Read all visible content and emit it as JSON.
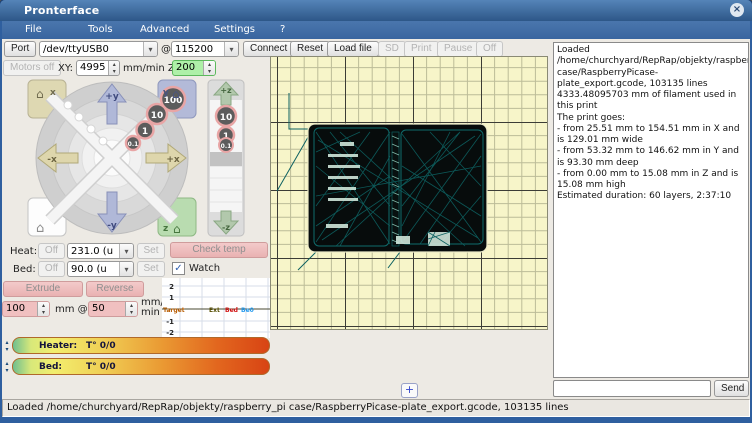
{
  "window": {
    "title": "Pronterface"
  },
  "icons": {
    "close": "×",
    "home": "⌂",
    "dropdown": "▾",
    "spin_up": "▴",
    "spin_down": "▾",
    "check": "✓",
    "plus": "+"
  },
  "menu": {
    "items": [
      "File",
      "Tools",
      "Advanced",
      "Settings",
      "?"
    ]
  },
  "toolbar": {
    "port_label": "Port",
    "port_value": "/dev/ttyUSB0",
    "at": "@",
    "baud_value": "115200",
    "connect": "Connect",
    "reset": "Reset",
    "load_file": "Load file",
    "sd": "SD",
    "print": "Print",
    "pause": "Pause",
    "off": "Off"
  },
  "motion": {
    "motors_off": "Motors off",
    "xy_label": "XY:",
    "xy_speed": "4995",
    "mmmin_z_label": "mm/min Z:",
    "z_speed": "200",
    "jog": {
      "home_x_label": "x",
      "home_y_label": "y",
      "home_z_label": "z",
      "plus_y": "+y",
      "minus_y": "-y",
      "plus_x": "+x",
      "minus_x": "-x",
      "plus_z": "+z",
      "minus_z": "-z",
      "xy_step_100": "100",
      "xy_step_10": "10",
      "xy_step_1": "1",
      "xy_step_01": "0.1",
      "z_step_10": "10",
      "z_step_1": "1",
      "z_step_01": "0.1"
    }
  },
  "temps": {
    "heat_label": "Heat:",
    "heat_off": "Off",
    "heat_value": "231.0 (u",
    "heat_set": "Set",
    "bed_label": "Bed:",
    "bed_off": "Off",
    "bed_value": "90.0 (u",
    "bed_set": "Set",
    "check_temp": "Check temp",
    "watch": "Watch"
  },
  "extrude": {
    "extrude": "Extrude",
    "reverse": "Reverse",
    "length": "100",
    "mm_at": "mm @",
    "speed": "50",
    "unit_line1": "mm/",
    "unit_line2": "min"
  },
  "graph": {
    "y_ticks": [
      "2",
      "1",
      "-1",
      "-2"
    ],
    "labels": [
      {
        "text": "Target",
        "color": "#b85c00"
      },
      {
        "text": "Ext",
        "color": "#554d00"
      },
      {
        "text": "Bed",
        "color": "#d01010"
      },
      {
        "text": "Be0",
        "color": "#2299ee"
      }
    ]
  },
  "gauges": [
    {
      "label": "Heater:",
      "value": "T° 0/0"
    },
    {
      "label": "Bed:",
      "value": "T° 0/0"
    }
  ],
  "log": {
    "text": "Loaded /home/churchyard/RepRap/objekty/raspberry_pi case/RaspberryPicase-plate_export.gcode, 103135 lines\n4333.48095703 mm of filament used in this print\nThe print goes:\n- from 25.51 mm to 154.51 mm in X and is 129.01 mm wide\n- from 53.32 mm to 146.62 mm in Y and is 93.30 mm deep\n- from 0.00 mm to 15.08 mm in Z and is 15.08 mm high\nEstimated duration: 60 layers, 2:37:10",
    "input_value": "",
    "send": "Send"
  },
  "statusbar": {
    "text": "Loaded /home/churchyard/RepRap/objekty/raspberry_pi case/RaspberryPicase-plate_export.gcode, 103135 lines"
  },
  "colors": {
    "titlebar": "#3c6ba5",
    "panel_bg": "#edeae4",
    "pink_accent": "#eab9b9",
    "green_accent": "#aef0a8",
    "canvas_bg": "#f7f5c9",
    "gcode_teal": "#0d6161",
    "print_fill": "#070c0c"
  }
}
